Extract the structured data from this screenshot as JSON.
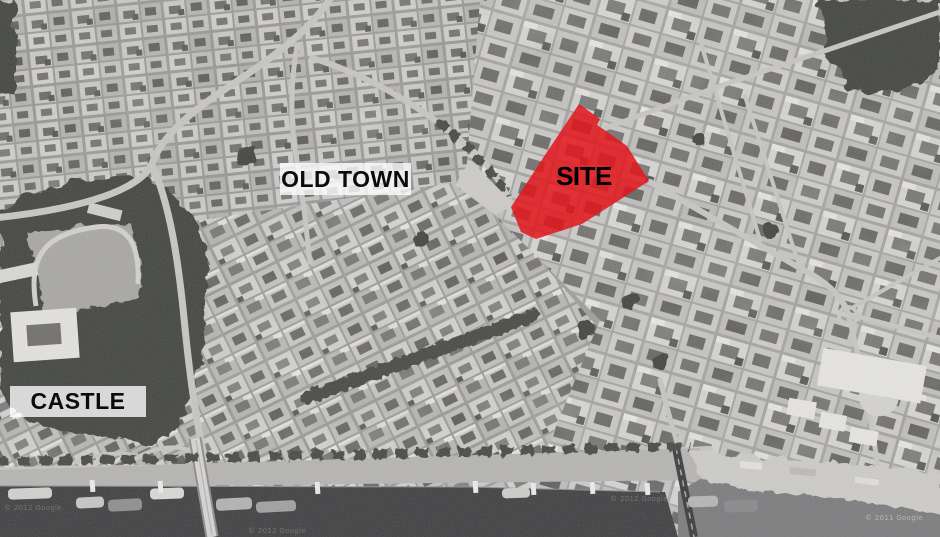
{
  "map": {
    "labels": {
      "old_town": "OLD TOWN",
      "castle": "CASTLE",
      "site": "SITE"
    },
    "watermarks": [
      "© 2012 Google",
      "© 2012 Google",
      "© 2012 Google",
      "© 2011 Google"
    ]
  },
  "colors": {
    "site_red": "#e2161c",
    "water_dark": "#3d3d3f",
    "water_light": "#7b7b7d",
    "label_background": "rgba(255,255,255,0.78)",
    "label_text": "#0b0b0b"
  }
}
